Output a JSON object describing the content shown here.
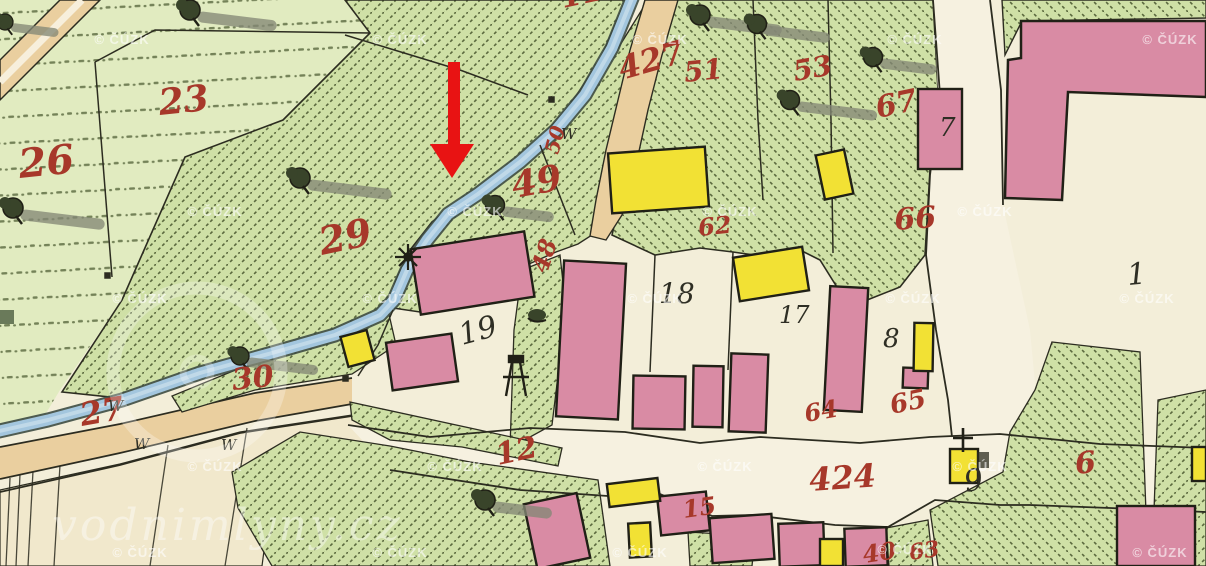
{
  "map": {
    "description": "historical hand-drawn cadastral map with annotation arrow",
    "palette": {
      "paper": "#f3eed9",
      "village": "#f6f1e0",
      "meadow": "#e1ebc0",
      "beige": "#f1e8cc",
      "garden": "#cfe0a6",
      "hatch": "#46552c",
      "road": "#eacf9f",
      "road_stripe": "#f7efdc",
      "stream": "#a3c6de",
      "stream_light": "#c6dcea",
      "stream_edge": "#3d4b42",
      "building_pink": "#d98ba4",
      "building_yellow": "#f2e134",
      "outline": "#202016",
      "boundary": "#2c2c20",
      "label_red": "#a7382a",
      "label_black": "#2e2e24",
      "tree_dark": "#39442a",
      "shadow_gray": "#848876",
      "watermark": "#ffffff",
      "arrow_red": "#e81313"
    },
    "annotation_arrow": {
      "shaft_x": 448,
      "shaft_y": 62,
      "shaft_w": 12,
      "shaft_h": 84,
      "head_points": "430,144 474,144 452,178"
    },
    "watermarks": {
      "copyright_text": "© ČÚZK",
      "site_text": "vodnimlyny.cz",
      "copyright_positions": [
        [
          122,
          44
        ],
        [
          400,
          44
        ],
        [
          660,
          44
        ],
        [
          915,
          44
        ],
        [
          1170,
          44
        ],
        [
          215,
          216
        ],
        [
          475,
          216
        ],
        [
          730,
          216
        ],
        [
          985,
          216
        ],
        [
          140,
          303
        ],
        [
          390,
          303
        ],
        [
          655,
          303
        ],
        [
          913,
          303
        ],
        [
          1147,
          303
        ],
        [
          215,
          471
        ],
        [
          455,
          471
        ],
        [
          725,
          471
        ],
        [
          980,
          471
        ],
        [
          140,
          557
        ],
        [
          400,
          557
        ],
        [
          640,
          557
        ],
        [
          905,
          554
        ],
        [
          1160,
          557
        ]
      ],
      "site_x": 52,
      "site_y": 540,
      "site_size": 44,
      "logo_ring": {
        "cx": 197,
        "cy": 372,
        "r": 84
      }
    },
    "labels": {
      "red_parcel_numbers": [
        {
          "t": "23",
          "x": 160,
          "y": 115,
          "s": 36,
          "r": -6
        },
        {
          "t": "26",
          "x": 20,
          "y": 178,
          "s": 40,
          "r": -6
        },
        {
          "t": "29",
          "x": 322,
          "y": 255,
          "s": 38,
          "r": -12
        },
        {
          "t": "30",
          "x": 233,
          "y": 390,
          "s": 30,
          "r": -6
        },
        {
          "t": "27",
          "x": 82,
          "y": 426,
          "s": 32,
          "r": -10
        },
        {
          "t": "49",
          "x": 514,
          "y": 198,
          "s": 36,
          "r": -10
        },
        {
          "t": "48",
          "x": 547,
          "y": 274,
          "s": 24,
          "r": -72
        },
        {
          "t": "50",
          "x": 558,
          "y": 155,
          "s": 20,
          "r": -75
        },
        {
          "t": "427",
          "x": 622,
          "y": 80,
          "s": 32,
          "r": -16
        },
        {
          "t": "51",
          "x": 685,
          "y": 82,
          "s": 28,
          "r": -6
        },
        {
          "t": "53",
          "x": 795,
          "y": 81,
          "s": 28,
          "r": -10
        },
        {
          "t": "67",
          "x": 878,
          "y": 118,
          "s": 30,
          "r": -12
        },
        {
          "t": "66",
          "x": 895,
          "y": 230,
          "s": 30,
          "r": -4
        },
        {
          "t": "62",
          "x": 699,
          "y": 236,
          "s": 24,
          "r": -6
        },
        {
          "t": "65",
          "x": 892,
          "y": 414,
          "s": 26,
          "r": -12
        },
        {
          "t": "64",
          "x": 806,
          "y": 422,
          "s": 24,
          "r": -10
        },
        {
          "t": "12",
          "x": 498,
          "y": 465,
          "s": 30,
          "r": -12
        },
        {
          "t": "15",
          "x": 684,
          "y": 518,
          "s": 24,
          "r": -8
        },
        {
          "t": "424",
          "x": 810,
          "y": 491,
          "s": 32,
          "r": -4
        },
        {
          "t": "6",
          "x": 1076,
          "y": 474,
          "s": 30,
          "r": -6
        },
        {
          "t": "11",
          "x": 563,
          "y": 8,
          "s": 30,
          "r": -12
        },
        {
          "t": "40",
          "x": 864,
          "y": 563,
          "s": 24,
          "r": -8
        },
        {
          "t": "63",
          "x": 910,
          "y": 560,
          "s": 22,
          "r": -8
        }
      ],
      "black_house_numbers": [
        {
          "t": "19",
          "x": 462,
          "y": 345,
          "s": 30,
          "r": -15
        },
        {
          "t": "18",
          "x": 659,
          "y": 303,
          "s": 28,
          "r": 0
        },
        {
          "t": "17",
          "x": 779,
          "y": 323,
          "s": 24,
          "r": 0
        },
        {
          "t": "8",
          "x": 883,
          "y": 347,
          "s": 26,
          "r": 0
        },
        {
          "t": "7",
          "x": 939,
          "y": 136,
          "s": 26,
          "r": 0
        },
        {
          "t": "1",
          "x": 1128,
          "y": 285,
          "s": 30,
          "r": -5
        },
        {
          "t": "9",
          "x": 966,
          "y": 492,
          "s": 30,
          "r": -10
        }
      ],
      "meadow_mark_char": "W",
      "meadow_marks": [
        [
          108,
          411
        ],
        [
          134,
          449
        ],
        [
          221,
          450
        ],
        [
          561,
          139
        ]
      ]
    },
    "symbols": {
      "trees": [
        {
          "x": 190,
          "y": 10,
          "len": 80,
          "sc": 1
        },
        {
          "x": 13,
          "y": 208,
          "len": 85,
          "sc": 1
        },
        {
          "x": 300,
          "y": 178,
          "len": 85,
          "sc": 1
        },
        {
          "x": 240,
          "y": 356,
          "len": 80,
          "sc": 0.9
        },
        {
          "x": 495,
          "y": 205,
          "len": 55,
          "sc": 0.95
        },
        {
          "x": 700,
          "y": 15,
          "len": 75,
          "sc": 1
        },
        {
          "x": 757,
          "y": 24,
          "len": 70,
          "sc": 0.95
        },
        {
          "x": 873,
          "y": 57,
          "len": 60,
          "sc": 0.95
        },
        {
          "x": 790,
          "y": 100,
          "len": 85,
          "sc": 0.95
        },
        {
          "x": 485,
          "y": 500,
          "len": 60,
          "sc": 1
        },
        {
          "x": 5,
          "y": 22,
          "len": 60,
          "sc": 0.8
        }
      ],
      "bush": {
        "x": 537,
        "y": 315
      },
      "mill_wheel": {
        "x": 408,
        "y": 257
      },
      "well": {
        "x": 516,
        "y": 378
      },
      "wayside_cross": {
        "x": 963,
        "y": 440
      }
    },
    "buildings": {
      "pink": [
        [
          415,
          240,
          115,
          66,
          -9
        ],
        [
          389,
          338,
          66,
          48,
          -8
        ],
        [
          560,
          262,
          62,
          156,
          3
        ],
        [
          633,
          376,
          52,
          53,
          1
        ],
        [
          693,
          366,
          30,
          61,
          1
        ],
        [
          730,
          354,
          37,
          78,
          2
        ],
        [
          827,
          287,
          38,
          124,
          3
        ],
        [
          903,
          368,
          25,
          20,
          2
        ],
        [
          918,
          89,
          44,
          80,
          0
        ],
        [
          530,
          498,
          54,
          66,
          -12
        ],
        [
          659,
          494,
          49,
          39,
          -6
        ],
        [
          711,
          516,
          62,
          45,
          -4
        ],
        [
          779,
          523,
          45,
          43,
          -2
        ],
        [
          845,
          528,
          42,
          38,
          -2
        ],
        [
          1117,
          506,
          78,
          60,
          0
        ]
      ],
      "yellow": [
        [
          610,
          150,
          97,
          60,
          -4
        ],
        [
          736,
          252,
          70,
          44,
          -9
        ],
        [
          914,
          323,
          19,
          48,
          1
        ],
        [
          344,
          333,
          27,
          31,
          -15
        ],
        [
          820,
          152,
          29,
          45,
          -12
        ],
        [
          608,
          481,
          51,
          23,
          -7
        ],
        [
          629,
          523,
          22,
          34,
          -3
        ],
        [
          820,
          539,
          23,
          27,
          0
        ],
        [
          950,
          449,
          28,
          34,
          0
        ],
        [
          1192,
          447,
          14,
          34,
          0
        ]
      ]
    }
  }
}
